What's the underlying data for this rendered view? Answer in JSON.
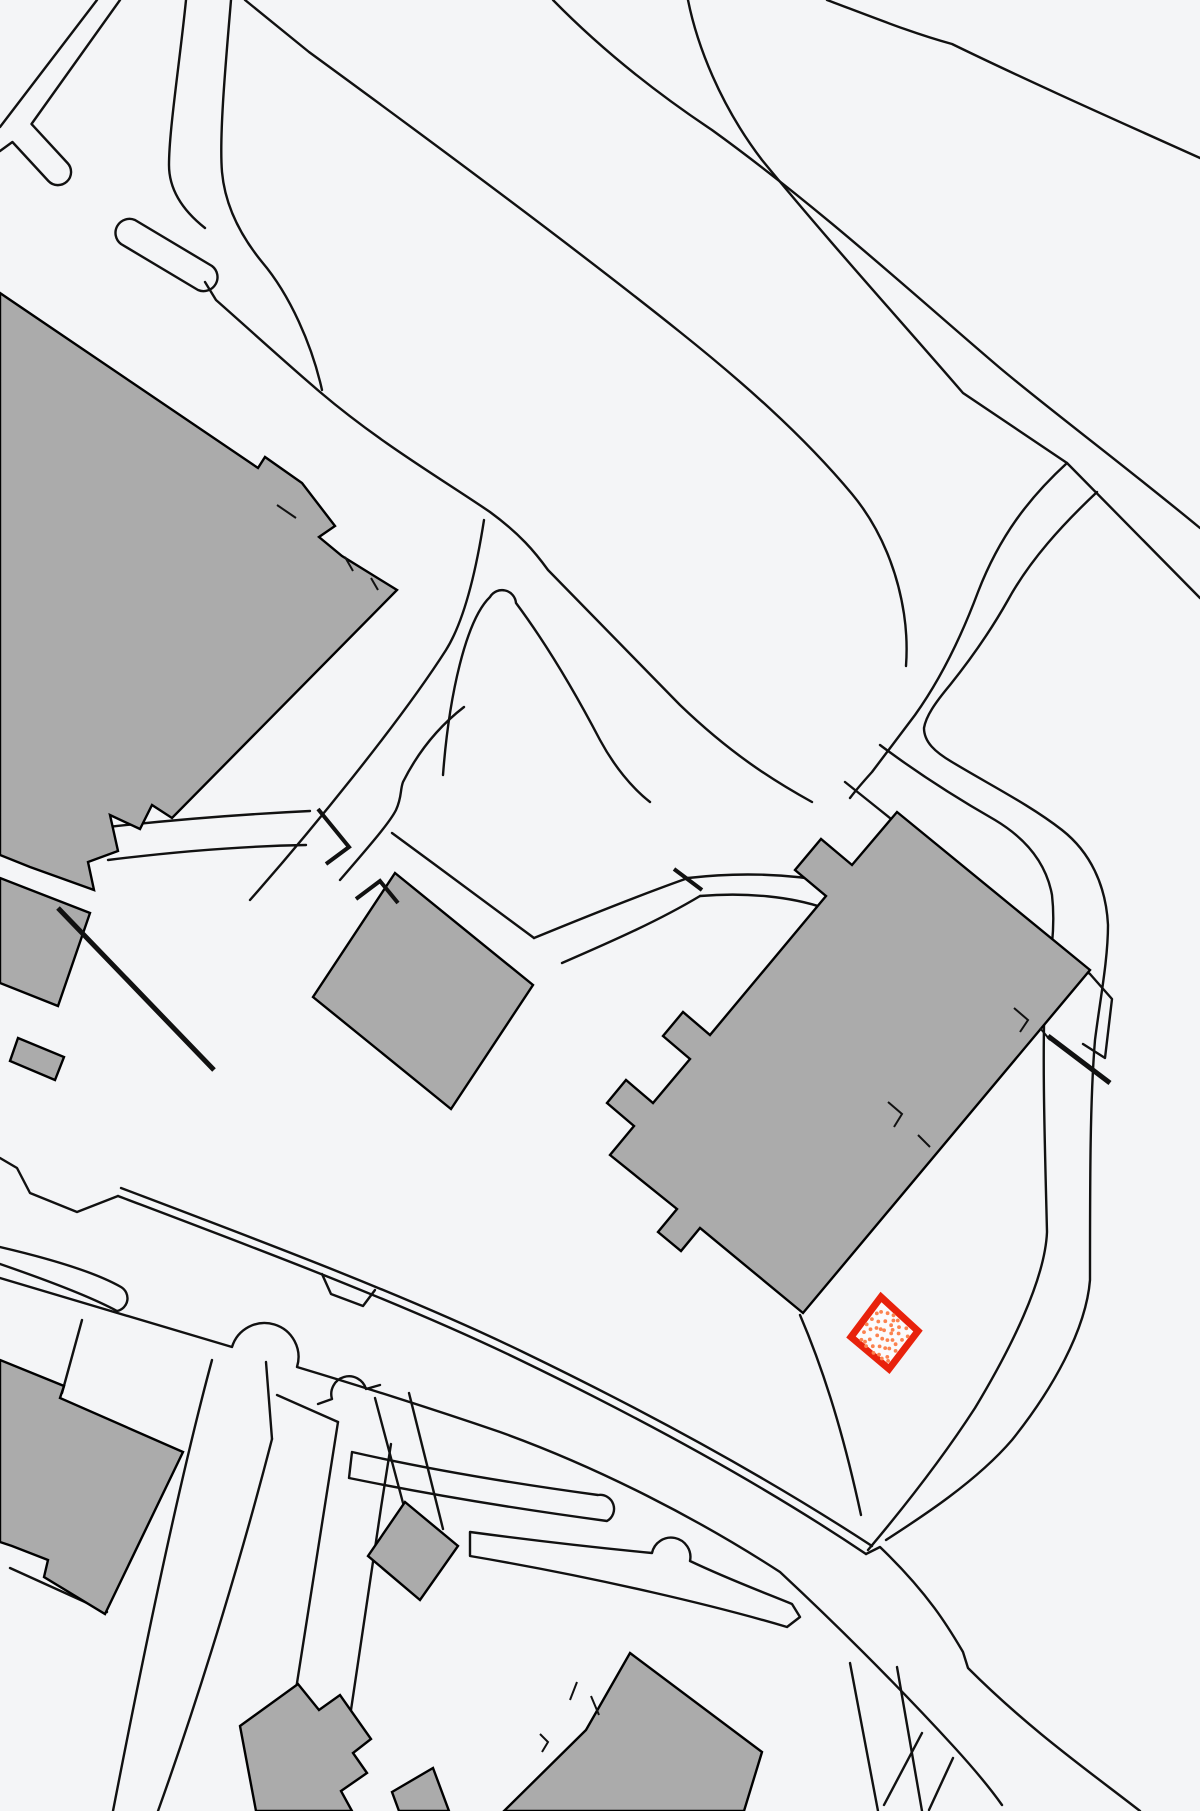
{
  "map": {
    "type": "cadastral-site-plan",
    "background_color": "#f4f5f7",
    "line_color": "#111111",
    "building_fill": "#ababab",
    "building_stroke": "#000000",
    "features": {
      "buildings_large": 3,
      "buildings_small": 6,
      "path_strips_rounded": 4,
      "road_islands": 3,
      "driveway_arcs": 3,
      "highlighted_parcels": 1
    },
    "highlight": {
      "label": "selected-parcel",
      "stroke_color": "#e8220c",
      "fill_color": "#fbfbfc",
      "dot_color": "#fb8350",
      "center_x": 884,
      "center_y": 1333,
      "corners": [
        [
          881,
          1297
        ],
        [
          918,
          1331
        ],
        [
          889,
          1369
        ],
        [
          851,
          1337
        ]
      ],
      "dots": [
        [
          0.12,
          0.45
        ],
        [
          0.18,
          0.22
        ],
        [
          0.22,
          0.62
        ],
        [
          0.25,
          0.4
        ],
        [
          0.3,
          0.15
        ],
        [
          0.3,
          0.52
        ],
        [
          0.33,
          0.78
        ],
        [
          0.36,
          0.3
        ],
        [
          0.4,
          0.62
        ],
        [
          0.42,
          0.1
        ],
        [
          0.45,
          0.45
        ],
        [
          0.46,
          0.84
        ],
        [
          0.5,
          0.28
        ],
        [
          0.52,
          0.6
        ],
        [
          0.55,
          0.12
        ],
        [
          0.57,
          0.75
        ],
        [
          0.6,
          0.4
        ],
        [
          0.62,
          0.55
        ],
        [
          0.65,
          0.2
        ],
        [
          0.66,
          0.88
        ],
        [
          0.7,
          0.48
        ],
        [
          0.72,
          0.3
        ],
        [
          0.75,
          0.65
        ],
        [
          0.78,
          0.12
        ],
        [
          0.8,
          0.5
        ],
        [
          0.82,
          0.8
        ],
        [
          0.85,
          0.35
        ],
        [
          0.88,
          0.6
        ],
        [
          0.9,
          0.22
        ],
        [
          0.15,
          0.75
        ],
        [
          0.2,
          0.9
        ],
        [
          0.35,
          0.93
        ],
        [
          0.55,
          0.93
        ],
        [
          0.75,
          0.9
        ],
        [
          0.88,
          0.85
        ],
        [
          0.1,
          0.6
        ],
        [
          0.48,
          0.18
        ],
        [
          0.68,
          0.7
        ],
        [
          0.28,
          0.88
        ],
        [
          0.58,
          0.33
        ],
        [
          0.38,
          0.48
        ],
        [
          0.13,
          0.3
        ]
      ]
    }
  }
}
